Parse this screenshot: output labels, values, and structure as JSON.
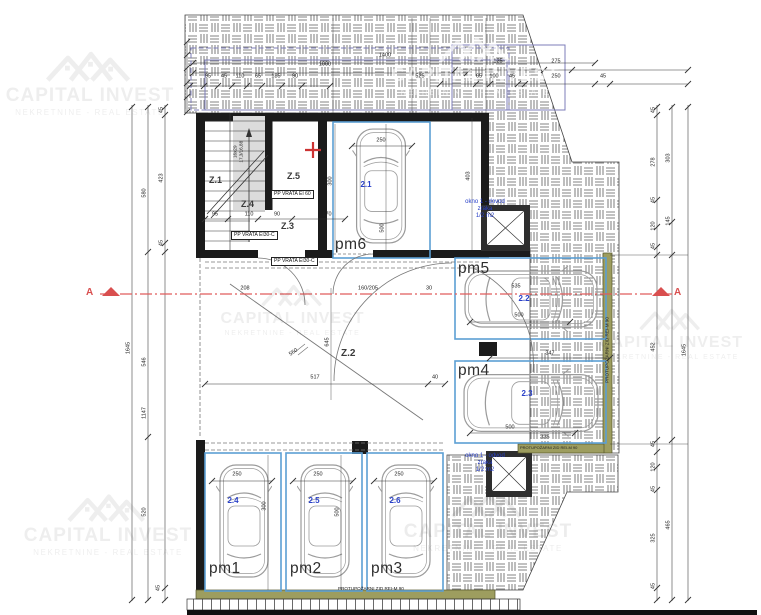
{
  "watermark": {
    "title": "CAPITAL INVEST",
    "subtitle": "NEKRETNINE - REAL ESTATE"
  },
  "section_marker": "A",
  "rooms": {
    "z1": "Z.1",
    "z2": "Z.2",
    "z3": "Z.3",
    "z4": "Z.4",
    "z5": "Z.5"
  },
  "parking_spots": [
    {
      "id": "pm1",
      "car": "2.4"
    },
    {
      "id": "pm2",
      "car": "2.5"
    },
    {
      "id": "pm3",
      "car": "2.6"
    },
    {
      "id": "pm4",
      "car": "2.3"
    },
    {
      "id": "pm5",
      "car": "2.2"
    },
    {
      "id": "pm6",
      "car": "2.1"
    }
  ],
  "doors": {
    "d1": "PP VRATA EI 60",
    "d2": "PP VRATA EI30-C",
    "d3": "PP VRATA EI30-C"
  },
  "windows": {
    "supply": {
      "l1": "okno 1 - dovod",
      "l2": "zraka",
      "l3": "1/2 m2"
    },
    "exhaust": {
      "l1": "okno 1 - odvod",
      "l2": "zraka",
      "l3": "1/2 m2"
    }
  },
  "firewall_label": "PROTUPOŽARNI ZID REI-M 90",
  "stairs_label": {
    "line1": "16x29",
    "line2": "17,3/16,88"
  },
  "dims": [
    "95",
    "45",
    "110",
    "65",
    "185",
    "90",
    "1000",
    "1400",
    "525",
    "125",
    "275",
    "65",
    "100",
    "45",
    "250",
    "45",
    "45",
    "423",
    "45",
    "580",
    "546",
    "1147",
    "520",
    "45",
    "1645",
    "45",
    "278",
    "45",
    "120",
    "45",
    "452",
    "303",
    "145",
    "1645",
    "45",
    "120",
    "45",
    "325",
    "45",
    "465",
    "517",
    "40",
    "250",
    "250",
    "250",
    "300",
    "500",
    "250",
    "300",
    "500",
    "535",
    "500",
    "347",
    "500",
    "335",
    "160/205",
    "30",
    "208",
    "645",
    "560",
    "403",
    "95",
    "110",
    "90",
    "170"
  ],
  "colors": {
    "accent_blue": "#5b9fd4",
    "firewall_olive": "#9d9d5f",
    "section_red": "#d94f4f",
    "overlay_purple": "#7c7cba",
    "label_blue": "#2940c8"
  }
}
